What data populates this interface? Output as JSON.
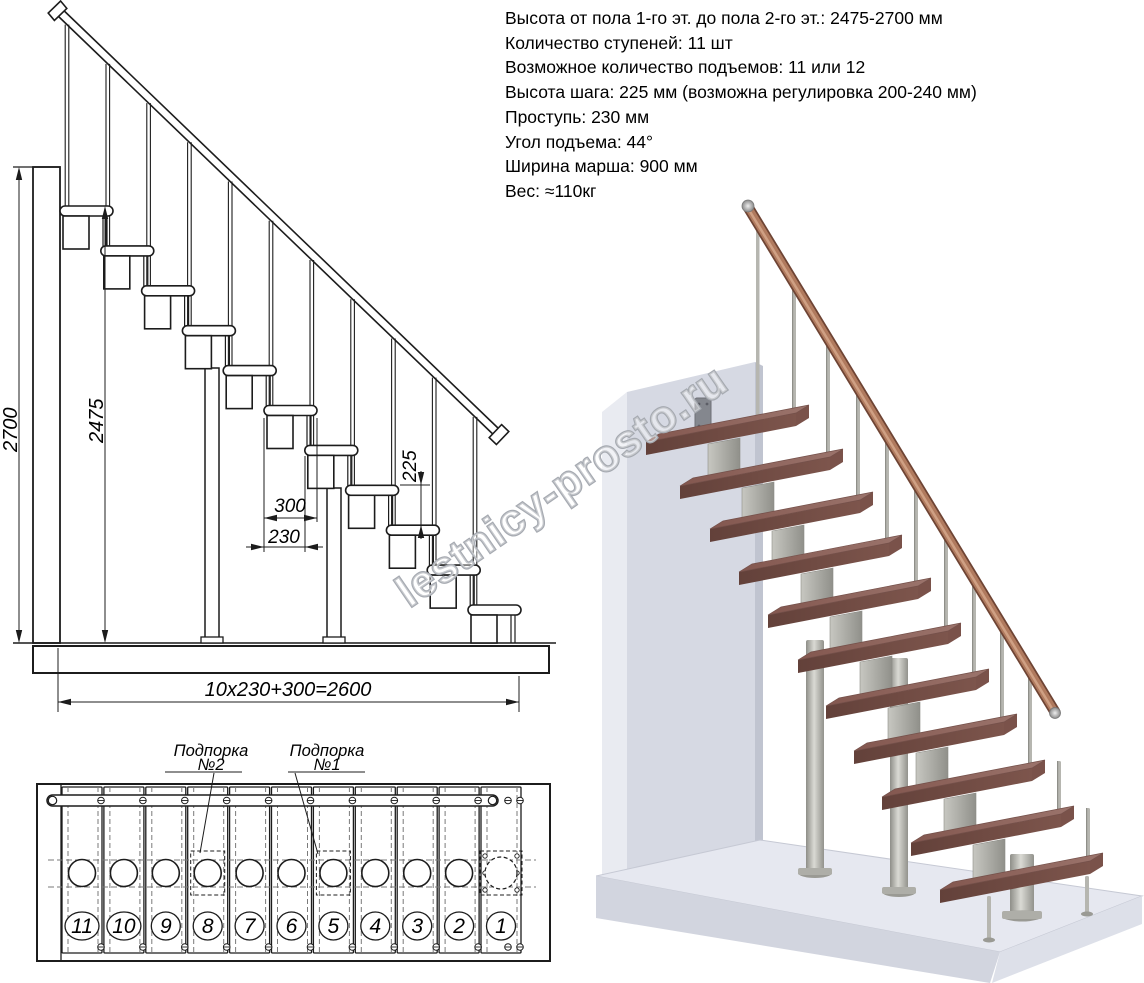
{
  "specs": {
    "lines": [
      "Высота от пола 1-го эт. до пола 2-го эт.: 2475-2700 мм",
      "Количество ступеней: 11 шт",
      "Возможное количество подъемов: 11 или 12",
      "Высота шага: 225 мм (возможна регулировка 200-240 мм)",
      "Проступь: 230 мм",
      "Угол подъема: 44°",
      "Ширина марша: 900 мм",
      "Вес: ≈110кг"
    ]
  },
  "elevation": {
    "dim_total_height": "2700",
    "dim_flight_height": "2475",
    "dim_tread_depth": "300",
    "dim_step_run": "230",
    "dim_step_rise": "225",
    "dim_total_run": "10x230+300=2600"
  },
  "plan": {
    "support2_line1": "Подпорка",
    "support2_line2": "№2",
    "support1_line1": "Подпорка",
    "support1_line2": "№1",
    "step_numbers": [
      "11",
      "10",
      "9",
      "8",
      "7",
      "6",
      "5",
      "4",
      "3",
      "2",
      "1"
    ]
  },
  "watermark": {
    "text": "lestnicy-prosto.ru"
  },
  "colors": {
    "line": "#1c1c1c",
    "dash": "#7a7a7a",
    "tread_top": "#8d6159",
    "tread_top_light": "#9b746c",
    "tread_front": "#6b463f",
    "tread_side": "#7a524a",
    "rail": "#b07a5e",
    "rail_dark": "#6e4434",
    "rail_light": "#cfa084",
    "metal": "#b6b6b0",
    "metal_dark": "#8f8f89",
    "wall_front": "#d6d9e3",
    "wall_left": "#e9ebf1",
    "wall_right": "#c0c4d0",
    "floor_top": "#e6e8f0",
    "floor_front": "#d2d5df",
    "floor_right": "#dde0e9",
    "watermark_stroke": "#a6aab1",
    "watermark_fill": "rgba(255,255,255,0.38)"
  }
}
